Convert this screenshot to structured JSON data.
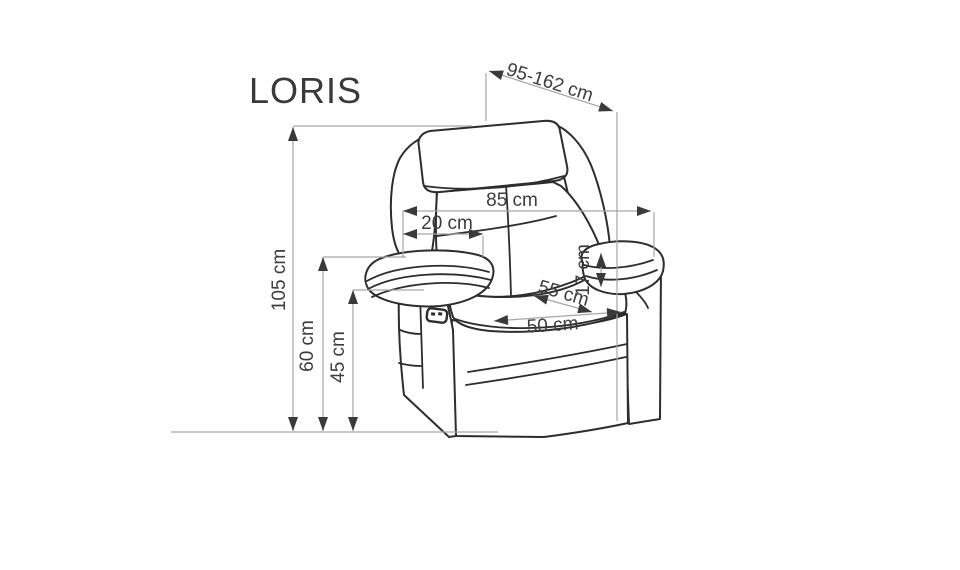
{
  "title": "LORIS",
  "dimensions": {
    "reclined_depth": "95-162 cm",
    "back_width": "85 cm",
    "headrest_depth": "20 cm",
    "arm_above_seat": "17 cm",
    "seat_depth": "55 cm",
    "seat_width": "50 cm",
    "total_height": "105 cm",
    "arm_height": "60 cm",
    "seat_height": "45 cm"
  },
  "colors": {
    "background": "#ffffff",
    "drawing_ink": "#2d2d2d",
    "dimension_line": "#a6a6a6",
    "arrowhead": "#3a3a3a",
    "label_text": "#3d3d3d"
  }
}
